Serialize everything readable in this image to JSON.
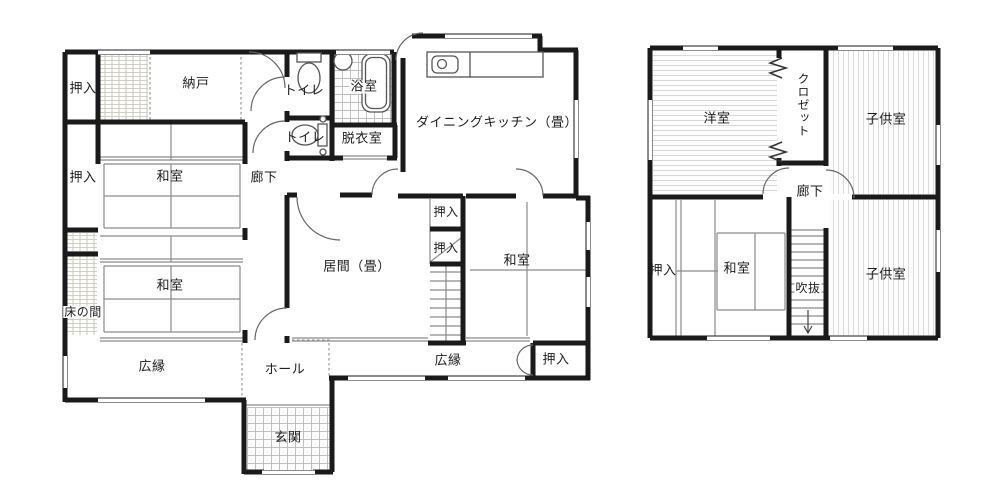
{
  "title": "2-story house floor plan",
  "colors": {
    "wall": "#1a1a1a",
    "thin_line": "#8a8a8a",
    "fixture_line": "#555555",
    "floor_line": "#d7d7d7",
    "tile_line": "#bfbfbf",
    "text": "#1c1c1c",
    "background": "#ffffff"
  },
  "icons": {
    "toilet": "toilet-icon",
    "bathtub": "bathtub-icon",
    "washbasin": "washbasin-icon",
    "kitchen_sink": "kitchen-sink-icon",
    "stairs": "stairs-treads",
    "accordion_door": "accordion-door-icon",
    "door_arc": "door-swing-arc",
    "down_arrow": "down-arrow-icon"
  },
  "f1": {
    "name": "1st floor plan",
    "oshiire_nw": "押入",
    "nando": "納戸",
    "toilet1": "トイレ",
    "bath": "浴室",
    "toilet2": "トイレ",
    "datsuishitsu": "脱衣室",
    "dk": "ダイニングキッチン（畳）",
    "oshiire_w": "押入",
    "washitsu_nw": "和室",
    "rouka": "廊下",
    "ima": "居間（畳）",
    "oshiire_c1": "押入",
    "oshiire_c2": "押入",
    "washitsu_e": "和室",
    "tokonoma": "床の間",
    "washitsu_sw": "和室",
    "hiroen_w": "広縁",
    "hall": "ホール",
    "hiroen_e": "広縁",
    "oshiire_se": "押入",
    "genkan": "玄関"
  },
  "f2": {
    "name": "2nd floor plan",
    "youshitsu": "洋室",
    "closet": "クロゼット",
    "kodomo_n": "子供室",
    "rouka": "廊下",
    "oshiire": "押入",
    "washitsu": "和室",
    "fukinuke": "吹抜",
    "kodomo_s": "子供室"
  }
}
